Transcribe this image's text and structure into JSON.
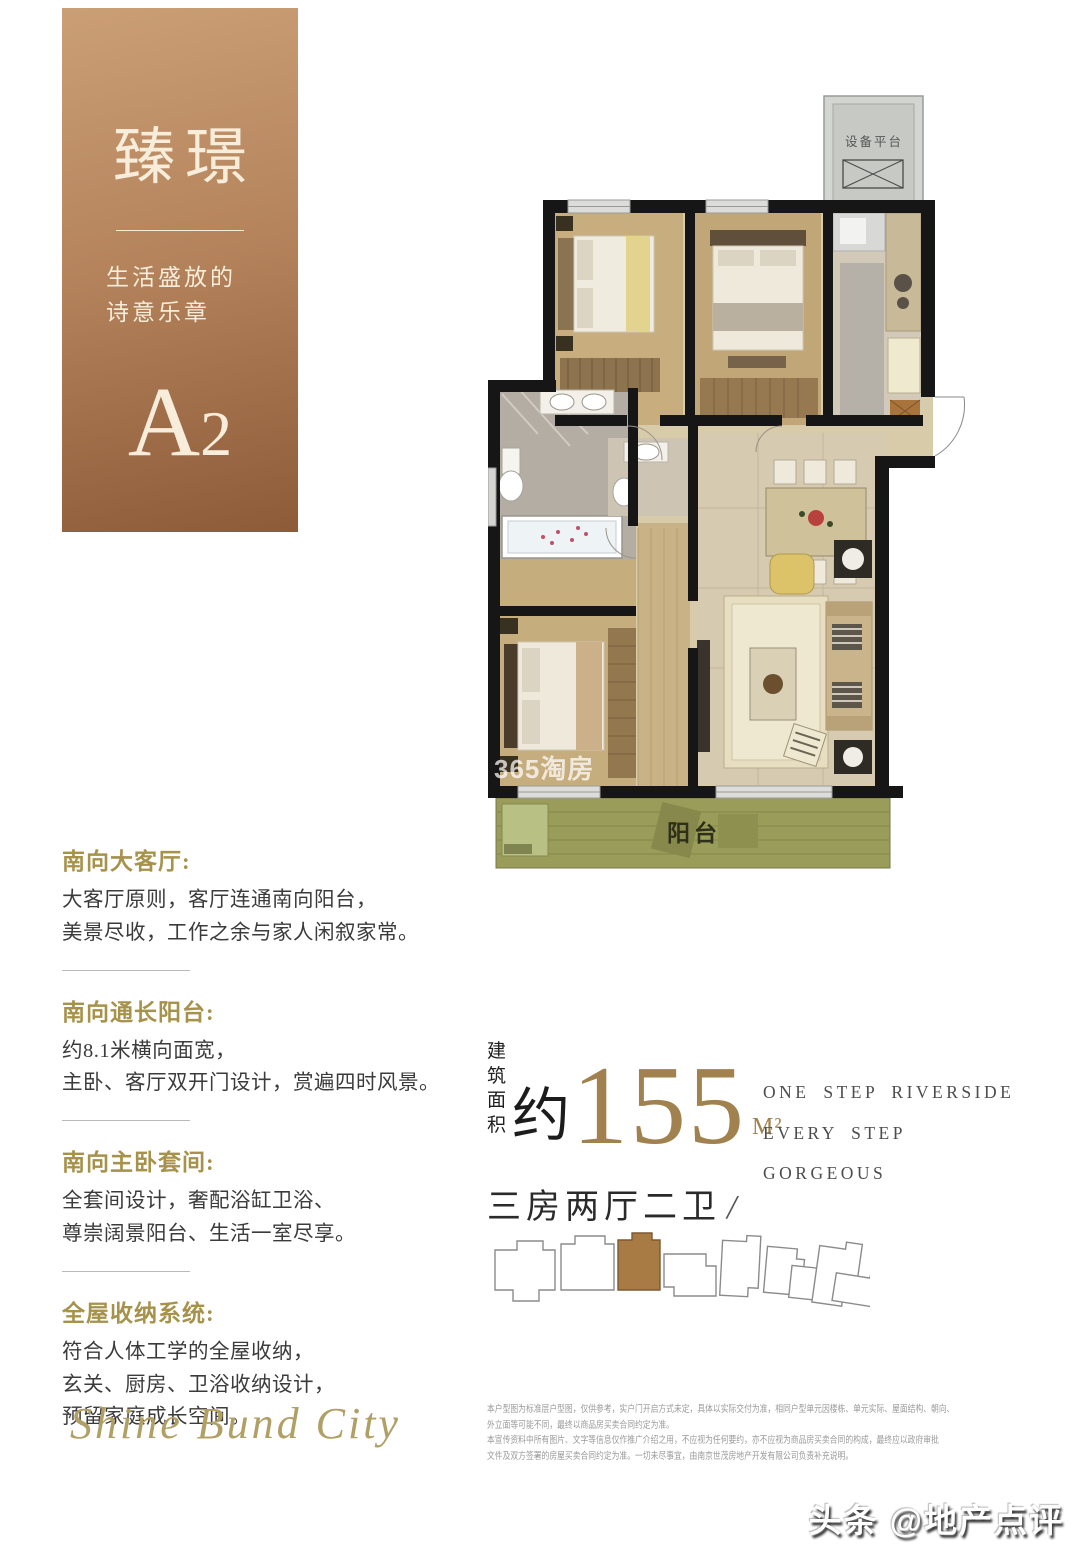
{
  "hero": {
    "title": "臻璟",
    "subtitle_line1": "生活盛放的",
    "subtitle_line2": "诗意乐章",
    "unit_letter": "A",
    "unit_number": "2",
    "gradient_top": "#cb9f76",
    "gradient_bottom": "#8d5b38"
  },
  "floorplan": {
    "equipment_label": "设备平台",
    "balcony_label": "阳台",
    "watermark": "365淘房"
  },
  "features": [
    {
      "title": "南向大客厅:",
      "lines": [
        "大客厅原则，客厅连通南向阳台，",
        "美景尽收，工作之余与家人闲叙家常。"
      ]
    },
    {
      "title": "南向通长阳台:",
      "lines": [
        "约8.1米横向面宽，",
        "主卧、客厅双开门设计，赏遍四时风景。"
      ]
    },
    {
      "title": "南向主卧套间:",
      "lines": [
        "全套间设计，奢配浴缸卫浴、",
        "尊崇阔景阳台、生活一室尽享。"
      ]
    },
    {
      "title": "全屋收纳系统:",
      "lines": [
        "符合人体工学的全屋收纳，",
        "玄关、厨房、卫浴收纳设计，",
        "预留家庭成长空间。"
      ]
    }
  ],
  "area": {
    "label_line1": "建筑",
    "label_line2": "面积",
    "approx": "约",
    "value": "155",
    "unit": "M²",
    "layout": "三房两厅二卫",
    "slash": "/"
  },
  "slogan": {
    "line1": "ONE STEP RIVERSIDE",
    "line2": "EVERY STEP",
    "line3": "GORGEOUS"
  },
  "logo_text": "Shine Bund City",
  "disclaimer": [
    "本户型图为标准层户型图，仅供参考，实户门开启方式未定，具体以实际交付为准，相同户型单元因楼栋、单元实际、屋面结构、朝向、",
    "外立面等可能不同，最终以商品房买卖合同约定为准。",
    "本宣传资料中所有图片、文字等信息仅作推广介绍之用，不应视为任何要约，亦不应视为商品房买卖合同的构成，最终应以政府审批",
    "文件及双方签署的房屋买卖合同约定为准。一切未尽事宜，由南京世茂房地产开发有限公司负责补充说明。"
  ],
  "badge_text": "头条 @地产点评",
  "colors": {
    "accent_gold": "#a6924a",
    "bronze_number": "#a1814e",
    "balcony_green": "#9a9c59",
    "highlight_building": "#a87a44"
  }
}
